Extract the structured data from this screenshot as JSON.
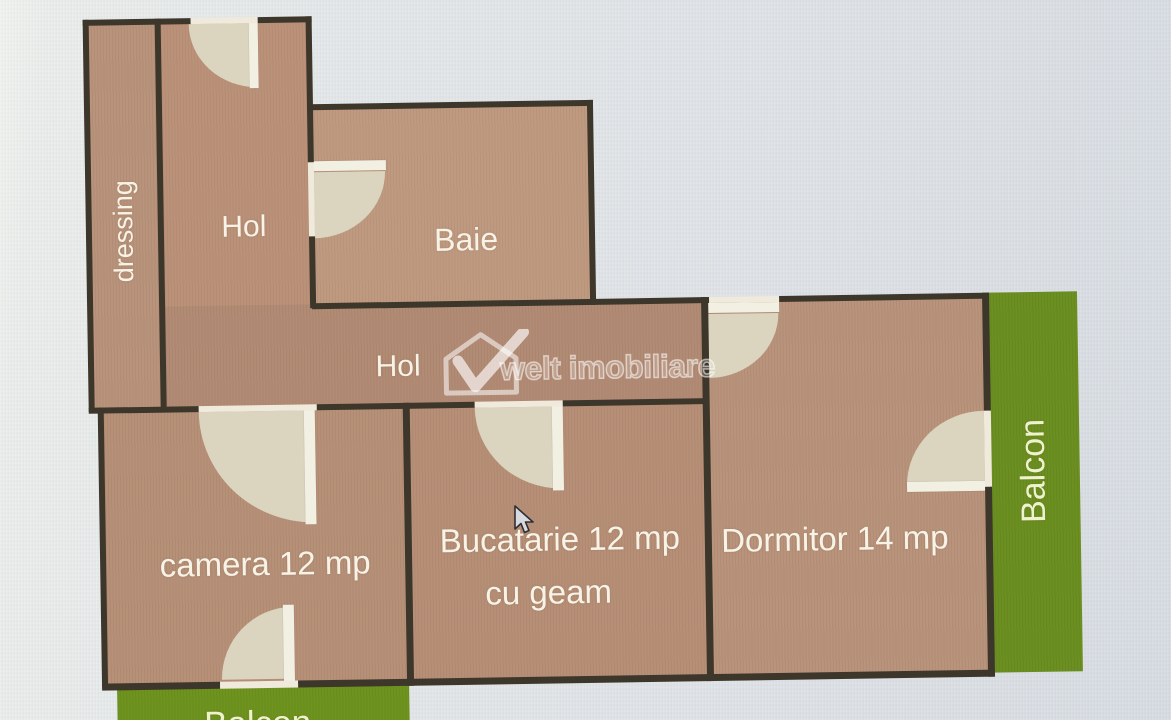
{
  "plan": {
    "type": "apartment-floor-plan",
    "rooms": {
      "dressing": {
        "label": "dressing"
      },
      "hol_top": {
        "label": "Hol"
      },
      "baie": {
        "label": "Baie"
      },
      "hol_corridor": {
        "label": "Hol"
      },
      "camera": {
        "label": "camera 12 mp"
      },
      "bucatarie": {
        "label": "Bucatarie 12 mp",
        "sublabel": "cu geam"
      },
      "dormitor": {
        "label": "Dormitor 14 mp"
      },
      "balcon_right": {
        "label": "Balcon"
      },
      "balcon_bottom": {
        "label": "Balcon"
      }
    },
    "watermark": {
      "text": "welt imobiliare",
      "logo": "house-checkmark-logo"
    },
    "cursor": "arrow-pointer",
    "colors": {
      "room_fill": "#b9937b",
      "wall": "#3d362b",
      "door_swing": "#dbd4bf",
      "door_leaf": "#f2efe3",
      "balcony_green": "#6b8f21",
      "balcony_label": "#eef3cd",
      "room_label": "#f8f3e7",
      "background": "#e2e6e9"
    }
  }
}
